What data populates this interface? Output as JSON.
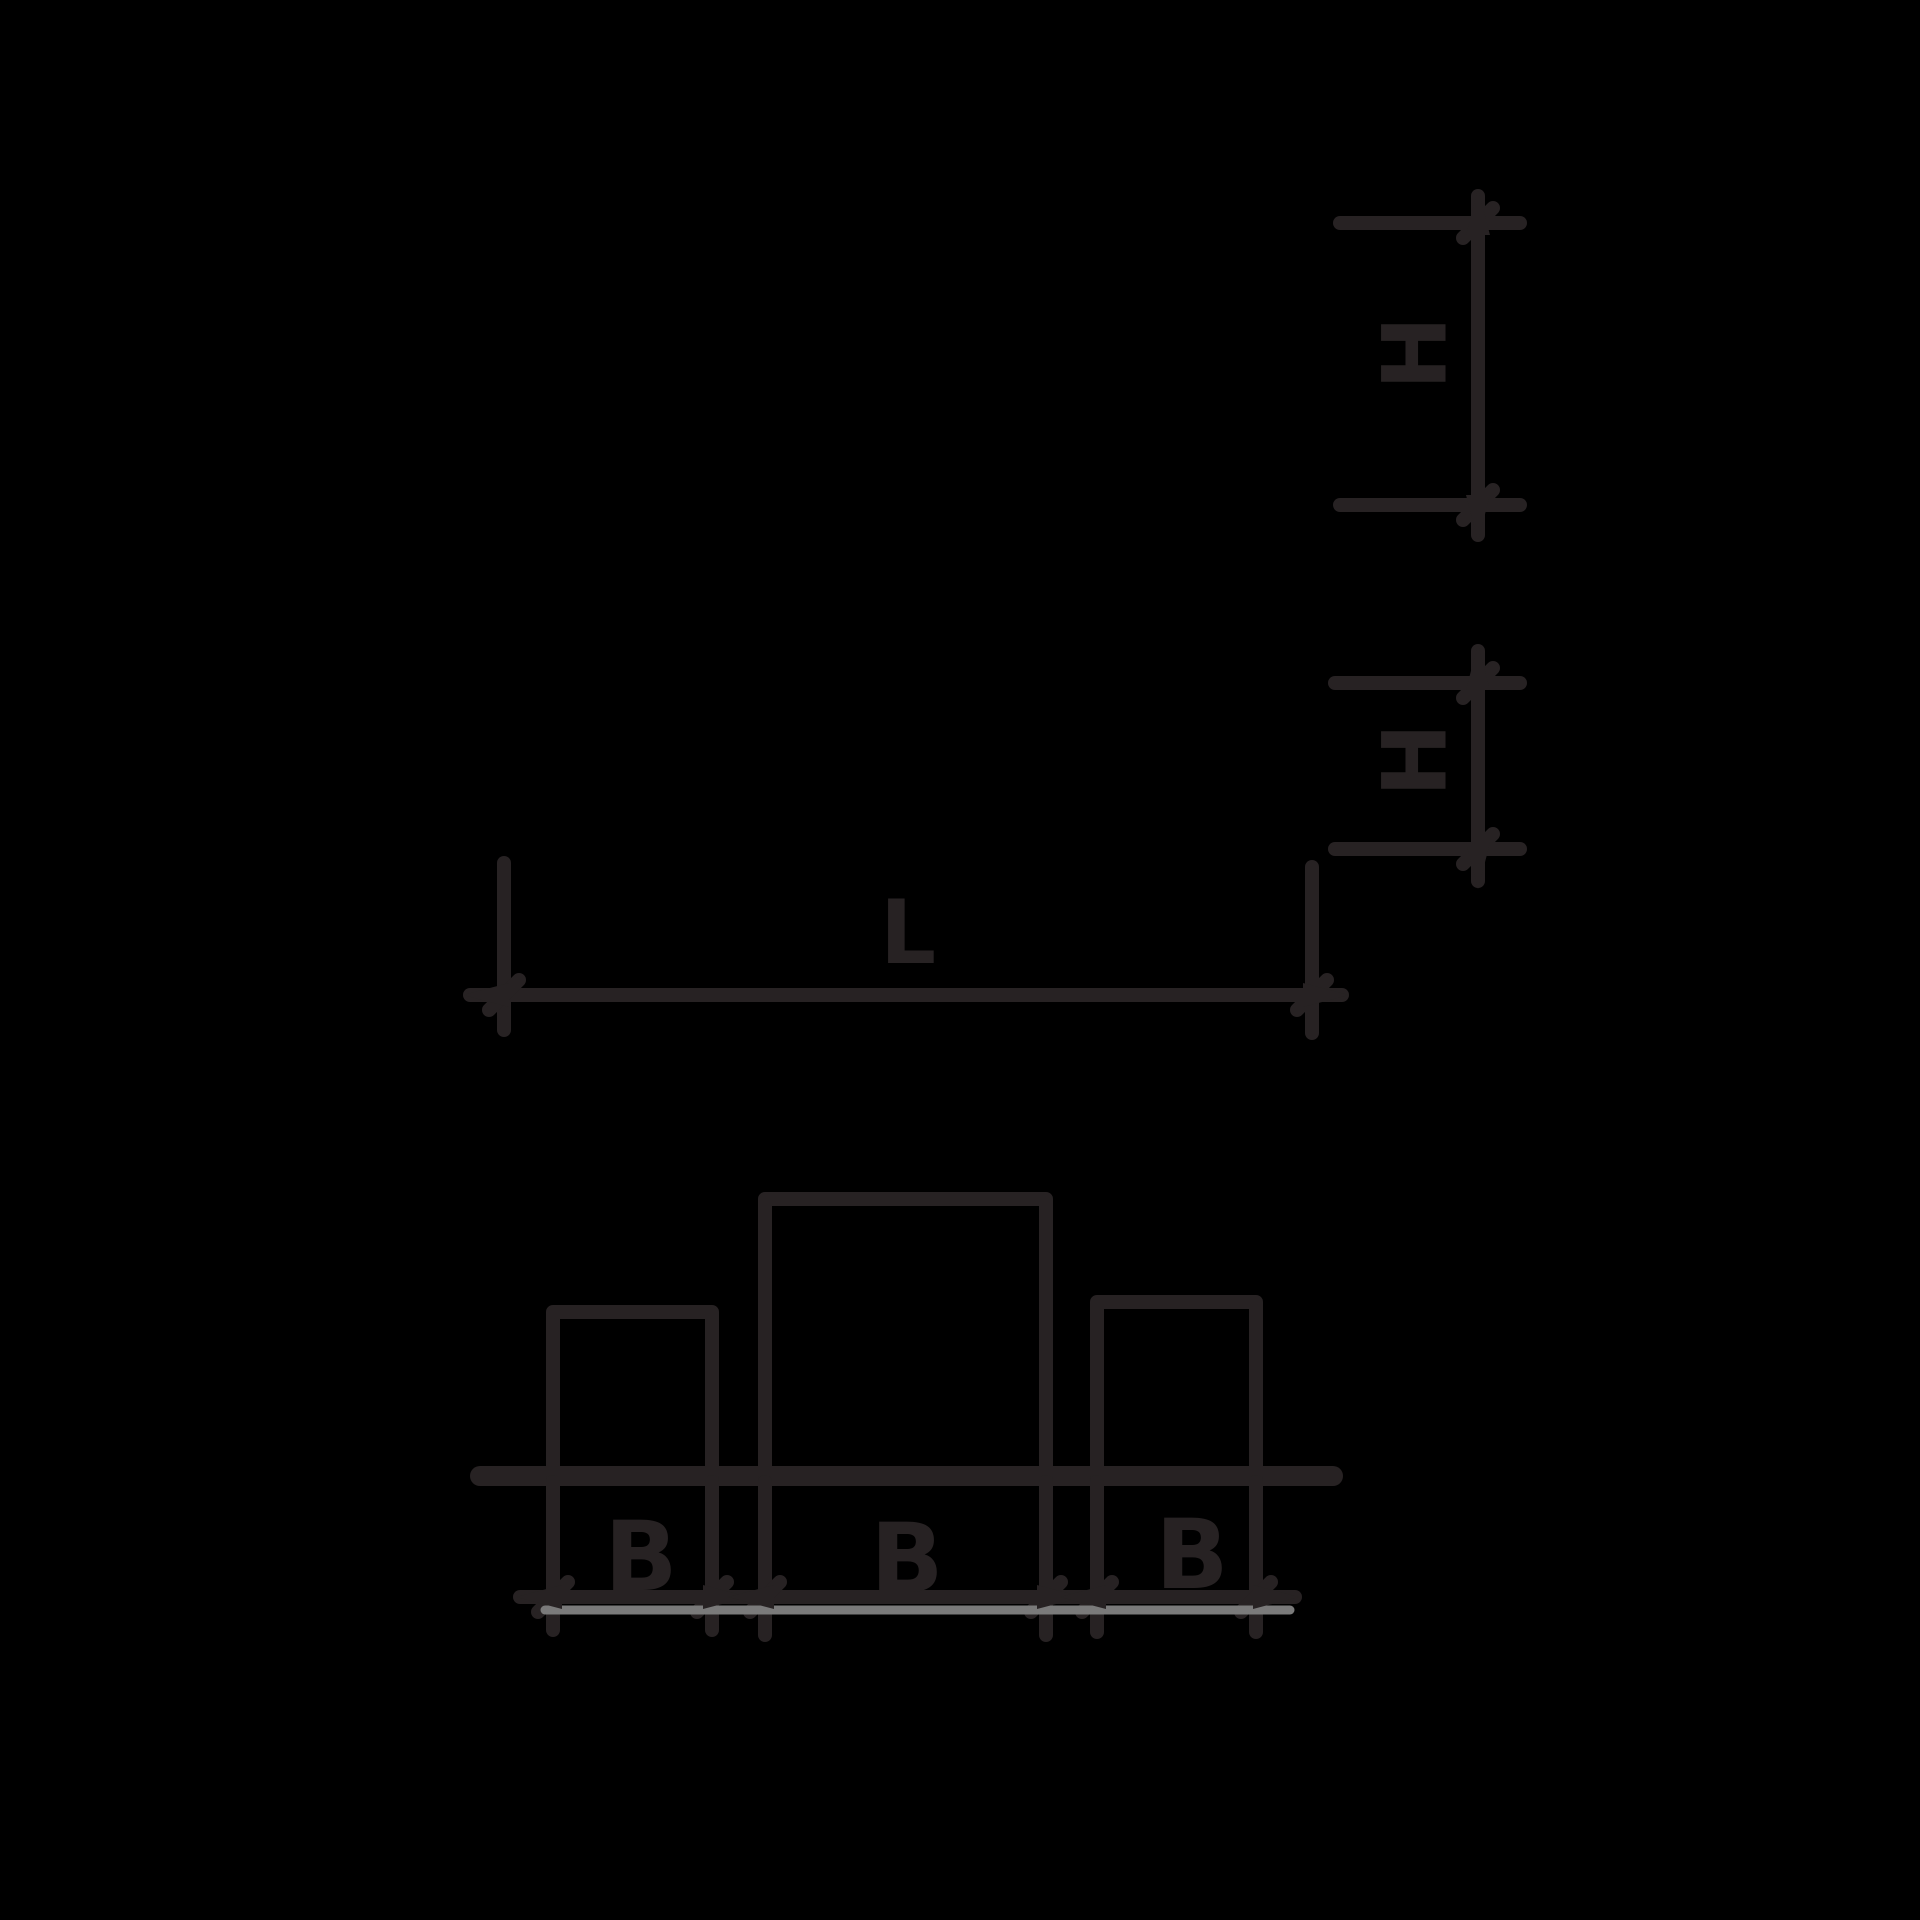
{
  "diagram": {
    "background_color": "#000000",
    "line_color": "#272223",
    "shadow_line_color": "#7a7a7a",
    "dimensions": {
      "upper_height": {
        "label": "H"
      },
      "lower_height": {
        "label": "H"
      },
      "length": {
        "label": "L"
      },
      "width_left": {
        "label": "B"
      },
      "width_middle": {
        "label": "B"
      },
      "width_right": {
        "label": "B"
      }
    }
  }
}
